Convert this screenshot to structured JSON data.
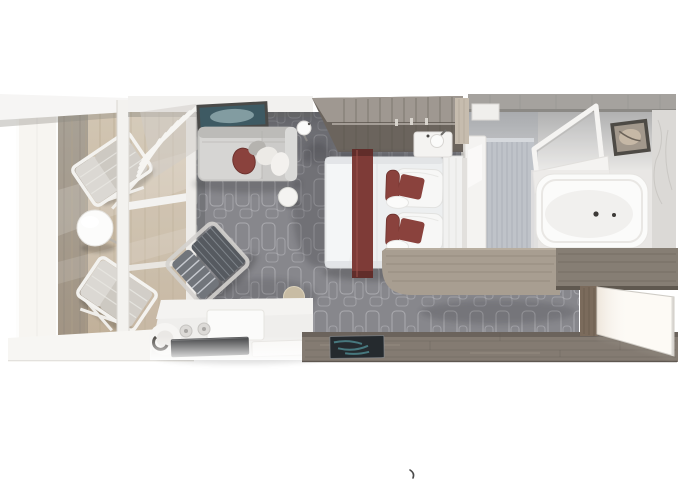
{
  "scene": {
    "type": "stateroom-floorplan-3d-render",
    "view": "top-down",
    "rooms": {
      "balcony": {
        "items": [
          "sun-lounger",
          "sun-lounger",
          "round-table",
          "glass-railing",
          "sliding-glass-door",
          "privacy-partition"
        ]
      },
      "living_room": {
        "items": [
          "sofa",
          "throw-pillows",
          "armchair",
          "round-ottoman",
          "tan-stool",
          "wall-art",
          "wall-lamp",
          "curtains",
          "vanity-desk",
          "desk-lamp",
          "desk-mat",
          "desk-tray"
        ]
      },
      "bedroom": {
        "items": [
          "double-bed",
          "bed-runner",
          "pillow-set",
          "pillow-set",
          "headboard",
          "nightstand",
          "nightstand",
          "wall-sconce",
          "wall-sconce",
          "wardrobe",
          "curved-console",
          "tv-console"
        ]
      },
      "bathroom": {
        "items": [
          "bathtub",
          "tub-faucet",
          "shower-enclosure",
          "towel-shelf",
          "marble-vanity-wall",
          "bathroom-door",
          "wall-art"
        ]
      },
      "entry": {
        "items": [
          "entry-door",
          "door-jamb",
          "door-mat",
          "wood-floor"
        ]
      }
    }
  },
  "colors": {
    "background": "#ffffff",
    "carpet": "#87878c",
    "carpet_pattern": "#b6b6bb",
    "balcony_glass": "#f7f5f1",
    "balcony_deck": "#d2c6b3",
    "balcony_deck_shaded": "#a39c92",
    "wall_light": "#f2f1ef",
    "sofa": "#cccbc9",
    "accent_maroon": "#7e3b37",
    "pillow_maroon": "#8a423d",
    "armchair": "#565a60",
    "armchair_back": "#71757b",
    "stool_tan": "#c8bca4",
    "white_furniture": "#f4f3f1",
    "desk_mat": "#3a3b3d",
    "bed_white": "#edeff0",
    "headboard_white": "#f1f1f0",
    "wardrobe_wood": "#6b645d",
    "wardrobe_wood_light": "#a29b93",
    "console_wood": "#a89e91",
    "console_wood_dark": "#867e74",
    "bathroom_floor": "#e7e6e4",
    "bathroom_wall_top": "#a5a29e",
    "marble_wall": "#bfc3c9",
    "tub_white": "#fbfbfa",
    "art_living": "#3e5a63",
    "art_living_frame": "#4a4a48",
    "art_bath_frame": "#4d4a45",
    "entry_wood": "#847b72",
    "door_jamb_wood": "#7b6b5c",
    "door_white": "#fdfaf5",
    "mat_dark": "#252a2e",
    "mat_teal": "#4d868c"
  }
}
